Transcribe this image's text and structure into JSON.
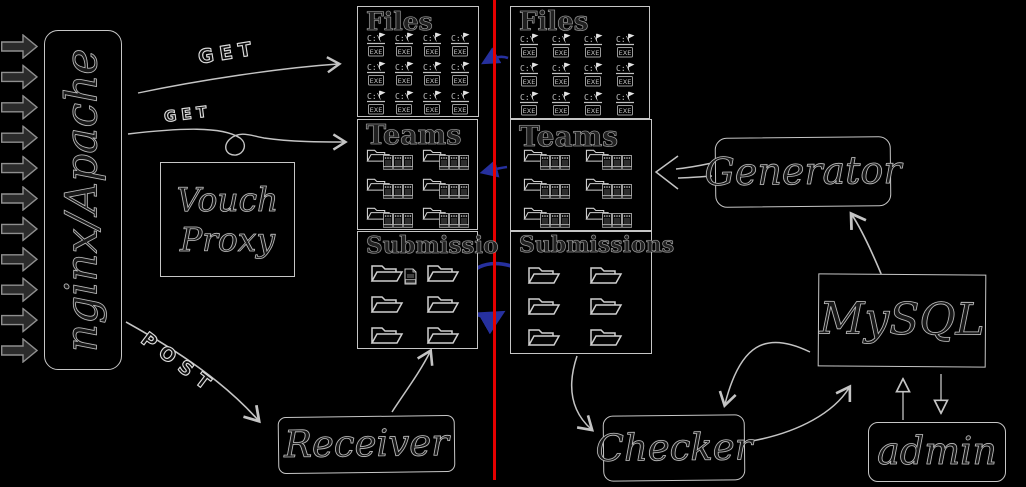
{
  "diagram": {
    "divider_color": "#e60000",
    "blue_accent": "#26309e",
    "ink_edge": "#c6c6c6",
    "edge_labels": {
      "get_top": "GET",
      "get_mid": "GET",
      "post": "POST"
    }
  },
  "nodes": {
    "nginx": {
      "label": "nginx/Apache"
    },
    "vouch": {
      "line1": "Vouch",
      "line2": "Proxy"
    },
    "receiver": {
      "label": "Receiver"
    },
    "generator": {
      "label": "Generator"
    },
    "mysql": {
      "label": "MySQL"
    },
    "admin": {
      "label": "admin"
    },
    "checker": {
      "label": "Checker"
    }
  },
  "input_arrows": {
    "rows": 11,
    "cols": 1,
    "icon": "request-arrow-icon"
  },
  "left_store": {
    "files": {
      "title": "Files",
      "rows": 3,
      "cols": 4,
      "icon": "dos-exe-file-icon"
    },
    "teams": {
      "title": "Teams",
      "rows": 3,
      "cols": 2,
      "icon": "team-folder-icon"
    },
    "submissions": {
      "title": "Submissio",
      "rows": 3,
      "cols": 2,
      "icon": "open-folder-icon"
    }
  },
  "right_store": {
    "files": {
      "title": "Files",
      "rows": 3,
      "cols": 4,
      "icon": "dos-exe-file-icon"
    },
    "teams": {
      "title": "Teams",
      "rows": 3,
      "cols": 2,
      "icon": "team-folder-icon"
    },
    "submissions": {
      "title": "Submissions",
      "rows": 3,
      "cols": 2,
      "icon": "open-folder-icon"
    }
  },
  "icons": {
    "exe_drive": "C:\\",
    "exe_label": "EXE"
  }
}
